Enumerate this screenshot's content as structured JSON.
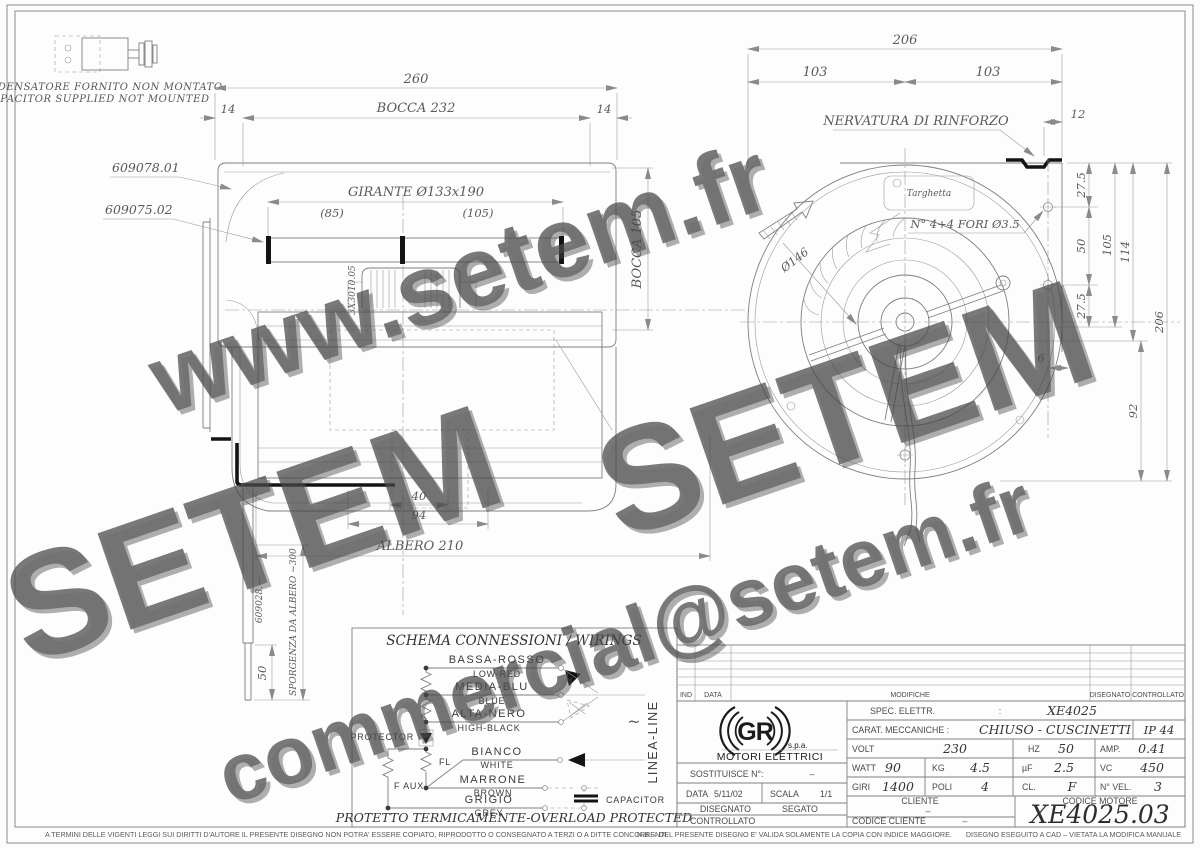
{
  "watermark": {
    "items": [
      "www.setem.fr",
      "SETEM",
      "SETEM",
      "commercial@setem.fr"
    ]
  },
  "capacitor_note": {
    "line1": "CONDENSATORE FORNITO NON MONTATO",
    "line2": "CAPACITOR SUPPLIED NOT MOUNTED"
  },
  "left_view": {
    "labels": {
      "part1": "609078.01",
      "part2": "609075.02",
      "motor": "3X3010.05",
      "shaft_part": "609028.—",
      "sporgenza": "SPORGENZA DA ALBERO ~300"
    },
    "dims": {
      "overall": "260",
      "side_l": "14",
      "bocca": "BOCCA 232",
      "side_r": "14",
      "girante": "GIRANTE Ø133x190",
      "g85": "(85)",
      "g105": "(105)",
      "bocca_v": "BOCCA 105",
      "d40": "40",
      "d94": "94",
      "albero": "ALBERO 210",
      "d50": "50"
    }
  },
  "right_view": {
    "labels": {
      "nervatura": "NERVATURA DI RINFORZO",
      "targhetta": "Targhetta",
      "fori": "N° 4+4 FORI Ø3.5",
      "dia": "Ø146"
    },
    "dims": {
      "overall": "206",
      "half_l": "103",
      "half_r": "103",
      "d12": "12",
      "t275": "27.5",
      "d50": "50",
      "d105": "105",
      "d114": "114",
      "b275": "27.5",
      "d6": "6",
      "d92": "92",
      "v206": "206"
    }
  },
  "wiring": {
    "title": "SCHEMA CONNESSIONI / WIRINGS",
    "speeds": [
      {
        "it": "BASSA-ROSSO",
        "en": "LOW-RED"
      },
      {
        "it": "MEDIA-BLU",
        "en": "BLUE"
      },
      {
        "it": "ALTA-NERO",
        "en": "HIGH-BLACK"
      },
      {
        "it": "BIANCO",
        "en": "WHITE"
      },
      {
        "it": "MARRONE",
        "en": "BROWN"
      },
      {
        "it": "GRIGIO",
        "en": "GREY"
      }
    ],
    "protector": "PROTECTOR",
    "fl": "FL",
    "faux": "F AUX",
    "capacitor": "CAPACITOR",
    "line_label": "LINEA-LINE",
    "tilde": "~",
    "footer": "PROTETTO TERMICAMENTE-OVERLOAD PROTECTED"
  },
  "titleblock": {
    "rev": {
      "ind": "IND",
      "data": "DATA",
      "modifiche": "MODIFICHE",
      "disegnato": "DISEGNATO",
      "controllato": "CONTROLLATO"
    },
    "logo": {
      "gr": "GR",
      "spa": "s.p.a.",
      "name": "MOTORI ELETTRICI"
    },
    "spec_label": "SPEC. ELETTR.",
    "colon": ":",
    "spec_value": "XE4025",
    "carat_label": "CARAT. MECCANICHE :",
    "carat_value": "CHIUSO - CUSCINETTI",
    "ip": "IP 44",
    "volt_label": "VOLT",
    "volt": "230",
    "hz_label": "HZ",
    "hz": "50",
    "amp_label": "AMP.",
    "amp": "0.41",
    "watt_label": "WATT",
    "watt": "90",
    "kg_label": "KG",
    "kg": "4.5",
    "uf_label": "µF",
    "uf": "2.5",
    "vc_label": "VC",
    "vc": "450",
    "giri_label": "GIRI",
    "giri": "1400",
    "poli_label": "POLI",
    "poli": "4",
    "cl_label": "CL.",
    "cl": "F",
    "nvel_label": "N° VEL.",
    "nvel": "3",
    "sost_label": "SOSTITUISCE N°:",
    "sost_value": "–",
    "data_label": "DATA",
    "data_value": "5/11/02",
    "scala_label": "SCALA",
    "scala_value": "1/1",
    "disegnato_label": "DISEGNATO",
    "disegnato_value": "SEGATO",
    "controllato_label": "CONTROLLATO",
    "cliente_label": "CLIENTE",
    "cliente_value": "–",
    "cod_cliente_label": "CODICE CLIENTE",
    "cod_cliente_value": "–",
    "cod_motore_label": "CODICE MOTORE",
    "cod_motore_value": "XE4025.03"
  },
  "disclaimer": {
    "left": "A TERMINI DELLE VIGENTI LEGGI SUI DIRITTI D'AUTORE IL PRESENTE DISEGNO NON POTRA' ESSERE COPIATO, RIPRODOTTO O CONSEGNATO A TERZI O A DITTE CONCORRENTI.",
    "mid": "N.B. – DEL PRESENTE DISEGNO E' VALIDA SOLAMENTE LA COPIA CON INDICE MAGGIORE.",
    "right": "DISEGNO ESEGUITO A CAD – VIETATA LA MODIFICA MANUALE"
  }
}
